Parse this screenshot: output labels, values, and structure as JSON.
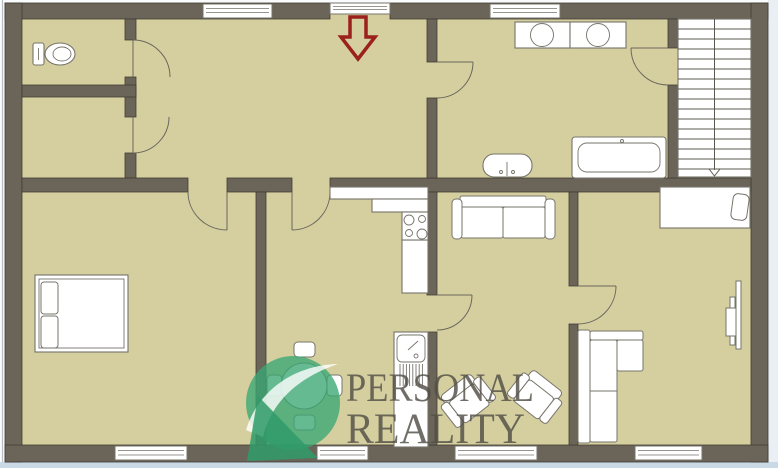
{
  "logo": {
    "line1": "PERSONAL",
    "line2": "REALITY"
  },
  "colors": {
    "floor": "#d5cfa0",
    "wall": "#6b6458",
    "wall-edge": "#413e34",
    "furn-stroke": "#76746a",
    "door": "#6a675c",
    "stair": "#5b594f",
    "arrow": "#9b211c",
    "logo-green": "#3aa773",
    "logo-green-dark": "#2f9b68",
    "logo-text": "#524f47",
    "page-bg": "#fafbfc",
    "frame-right": "#e9eff5",
    "frame-bottom": "#c9d9e6",
    "frame-line": "#b7bdc2"
  },
  "plan": {
    "type": "floor-plan",
    "entrance_marker": "red-down-arrow",
    "rooms": [
      "wc",
      "storage",
      "hallway",
      "bathroom",
      "staircase",
      "bedroom-left",
      "kitchen-dining",
      "living-room",
      "bedroom-right"
    ],
    "fixtures": [
      "toilet",
      "washing-machine",
      "dryer",
      "water-heater",
      "bathtub",
      "stairs-down",
      "kitchen-counter",
      "stove-4-burners",
      "sink-tall-cabinet",
      "dining-table-4-chairs",
      "double-bed-2-pillows",
      "two-seat-sofa",
      "armchair-left",
      "armchair-right",
      "corner-sofa",
      "single-bed",
      "radiator"
    ],
    "windows_count": 6,
    "doors_count": 8
  }
}
